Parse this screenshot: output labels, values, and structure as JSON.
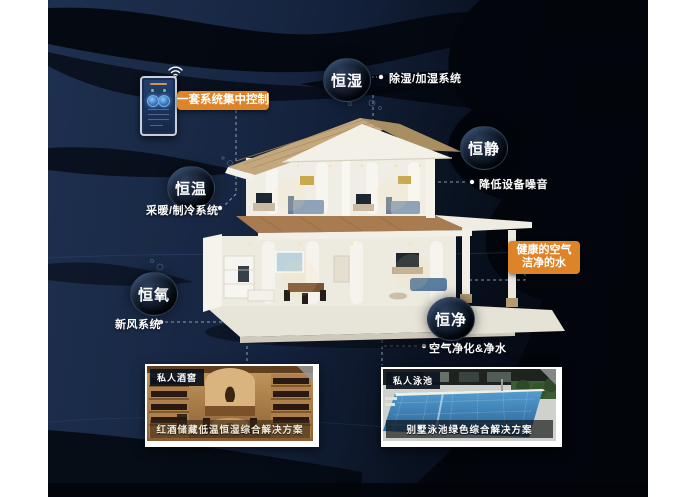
{
  "title": "恒适智能家居系统图",
  "icons": {
    "wifi": "wifi-icon",
    "control_panel": "control-panel-icon"
  },
  "highlights": {
    "control": "一套系统集中控制",
    "healthy": {
      "line1": "健康的空气",
      "line2": "洁净的水"
    }
  },
  "callouts": [
    {
      "id": "hengshi",
      "badge": "恒湿",
      "desc": "除湿/加湿系统"
    },
    {
      "id": "hengjing",
      "badge": "恒静",
      "desc": "降低设备噪音"
    },
    {
      "id": "hengwen",
      "badge": "恒温",
      "desc": "采暖/制冷系统"
    },
    {
      "id": "hengyang",
      "badge": "恒氧",
      "desc": "新风系统"
    },
    {
      "id": "hengjin",
      "badge": "恒净",
      "desc": "空气净化&净水"
    }
  ],
  "cards": [
    {
      "tag": "私人酒窖",
      "caption": "红酒储藏低温恒湿综合解决方案"
    },
    {
      "tag": "私人泳池",
      "caption": "别墅泳池绿色综合解决方案"
    }
  ],
  "colors": {
    "accent_orange": "#DD8428",
    "background_navy": "#15233E",
    "wave_black": "#04070E",
    "badge_text": "#FFFFFF",
    "pool_blue": "#2F6FA8",
    "wood_tan": "#B9894E"
  }
}
